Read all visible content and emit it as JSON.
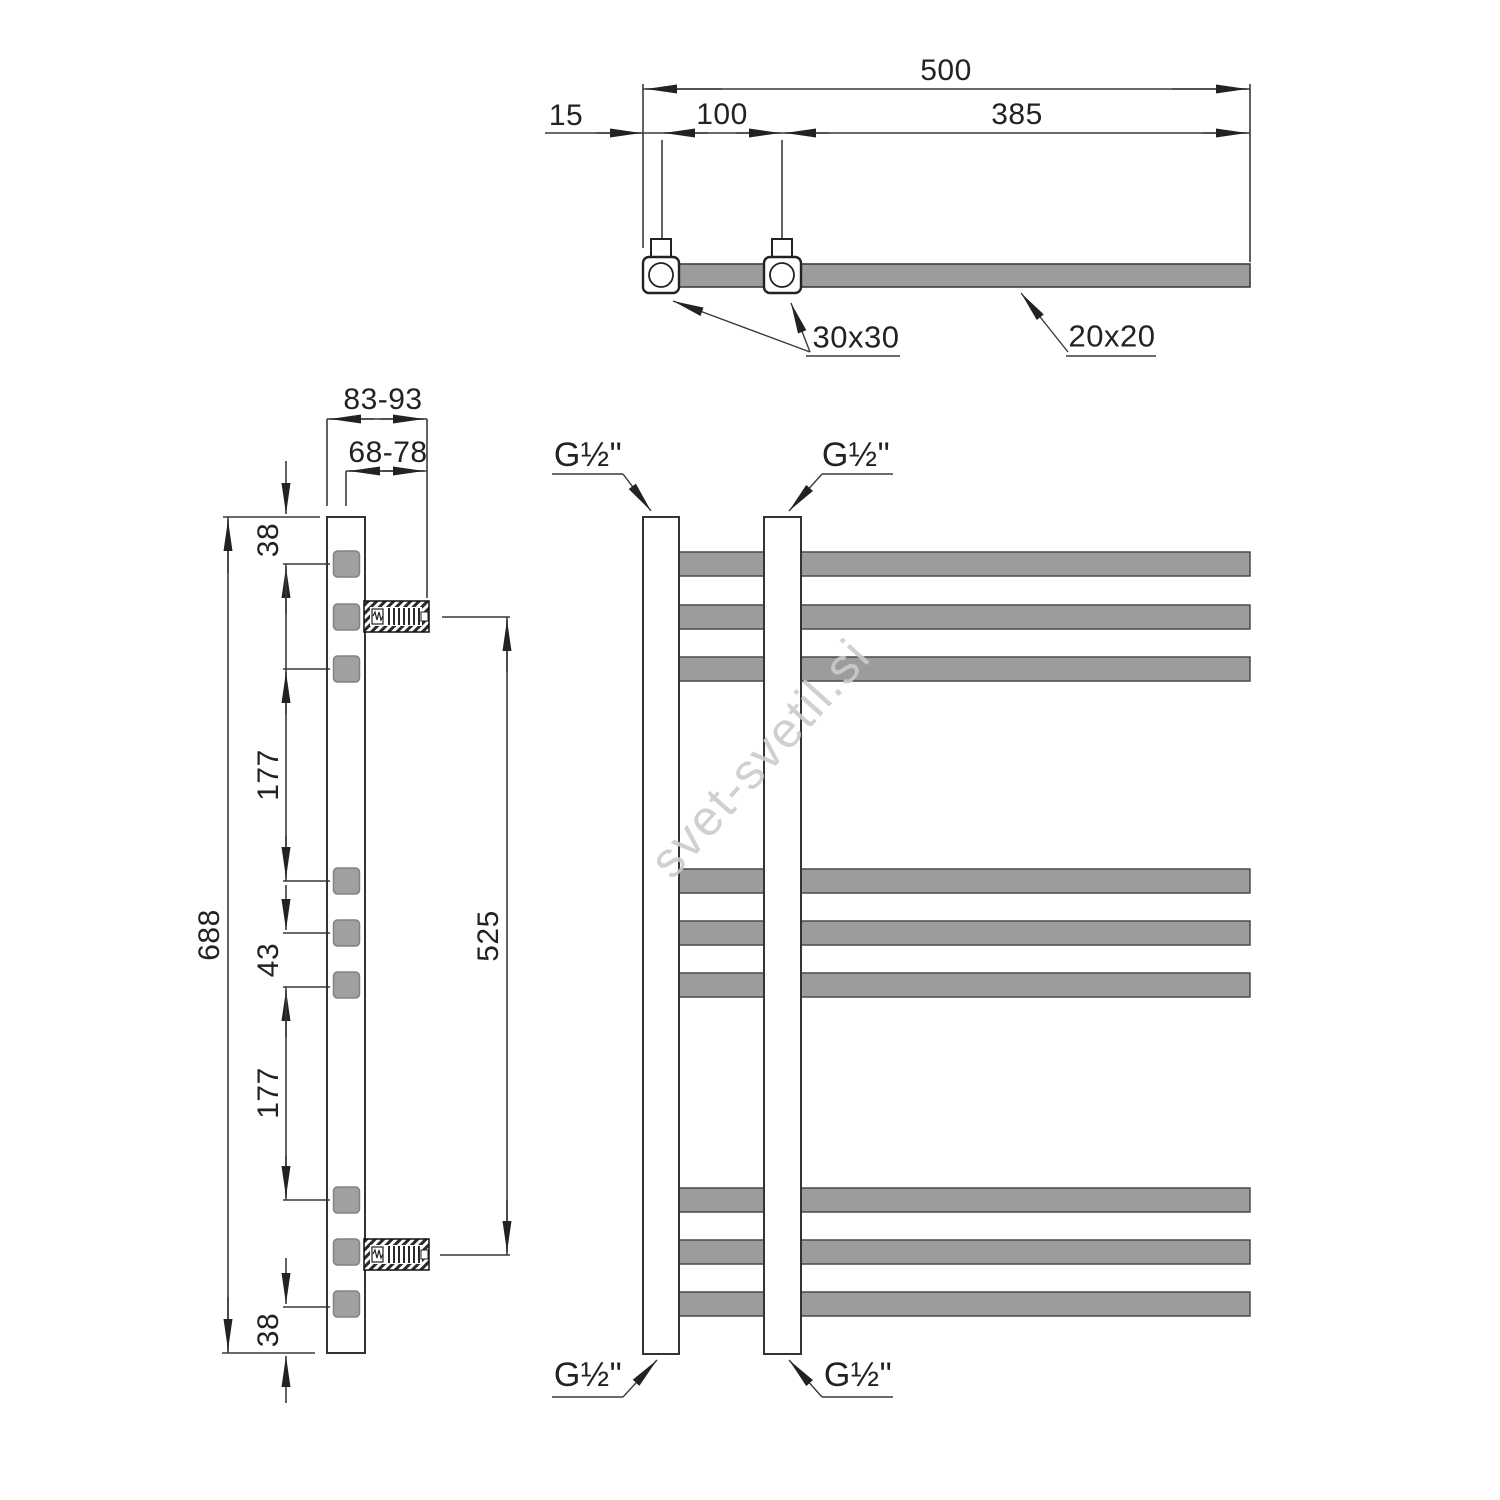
{
  "watermark": {
    "text": "svet-svetil.si"
  },
  "colors": {
    "metal_gray": "#9c9c9c",
    "line_dark": "#2d2d2d",
    "watermark_gray": "#cbcbcb"
  },
  "top_view": {
    "dims": {
      "total_width": "500",
      "edge_offset": "15",
      "connection_spacing": "100",
      "right_span": "385"
    },
    "labels": {
      "collector_profile": "30x30",
      "rung_profile": "20x20"
    }
  },
  "side_view": {
    "dims": {
      "wall_depth": "83-93",
      "axis_depth": "68-78",
      "top_gap": "38",
      "cluster_gap_upper": "177",
      "rung_gap": "43",
      "cluster_gap_lower": "177",
      "bottom_gap": "38",
      "total_height": "688",
      "bracket_span": "525"
    }
  },
  "front_view": {
    "threads": {
      "top_left": "G½\"",
      "top_right": "G½\"",
      "bottom_left": "G½\"",
      "bottom_right": "G½\""
    }
  }
}
